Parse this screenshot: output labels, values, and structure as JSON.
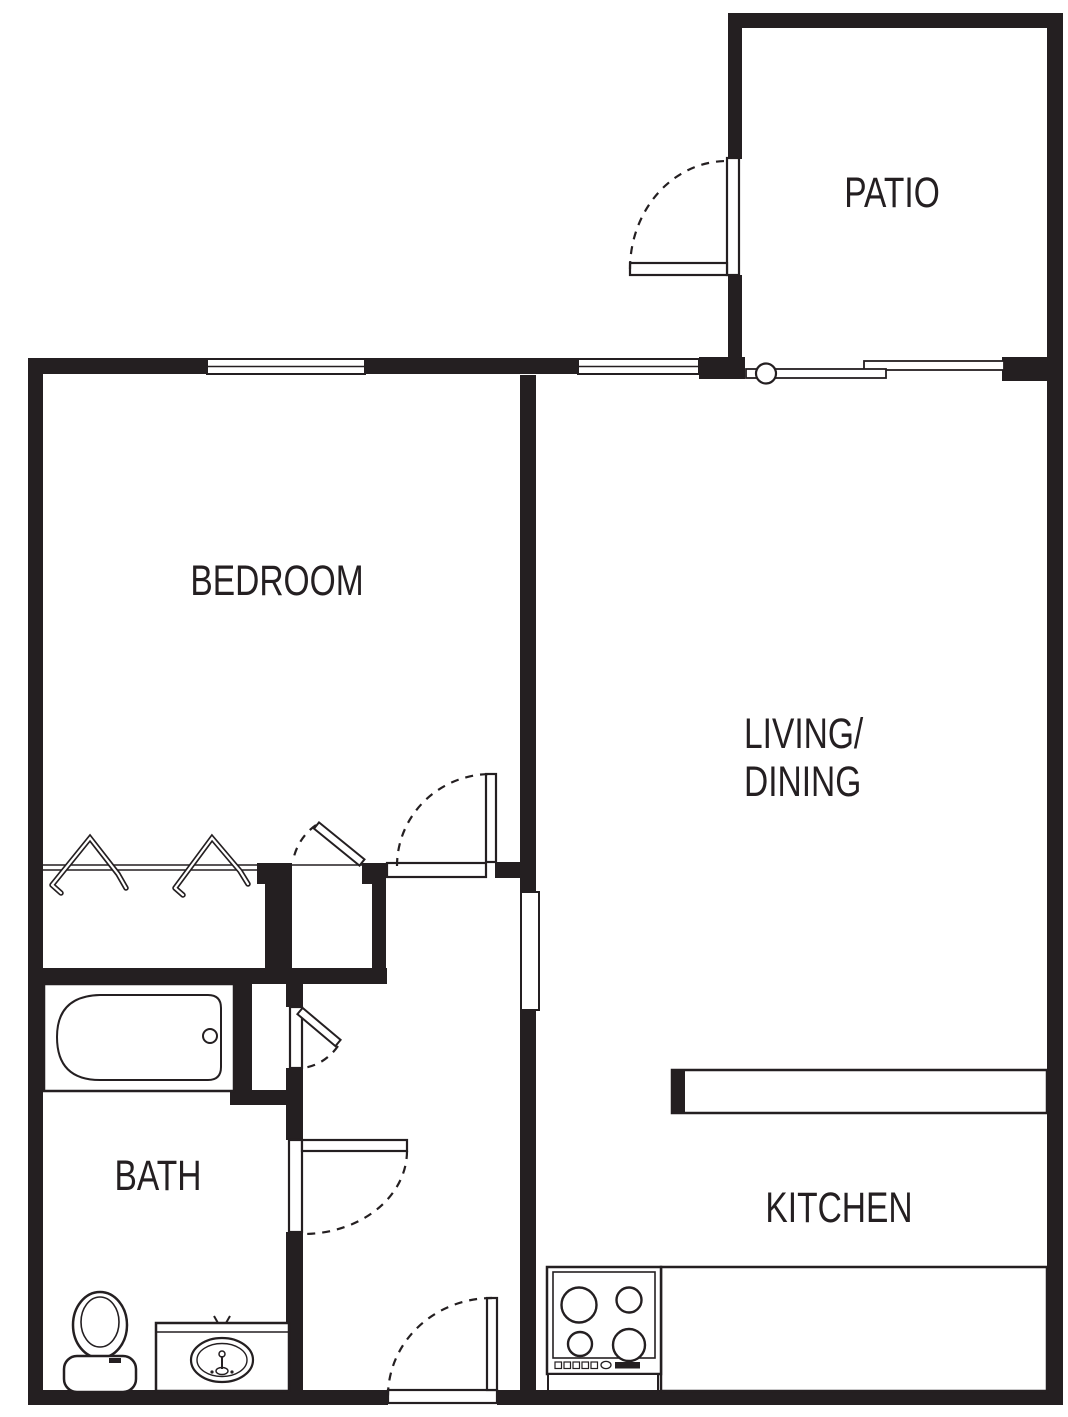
{
  "title": "one-bedroom apartment floor plan",
  "colors": {
    "wall": "#241f21",
    "background": "#ffffff",
    "fixture_line": "#241f21"
  },
  "rooms": {
    "patio": {
      "label": "PATIO"
    },
    "bedroom": {
      "label": "BEDROOM"
    },
    "living_dining": {
      "label_line1": "LIVING/",
      "label_line2": "DINING"
    },
    "bath": {
      "label": "BATH"
    },
    "kitchen": {
      "label": "KITCHEN"
    }
  },
  "fixtures": {
    "bathtub": "bathtub",
    "toilet": "toilet",
    "vanity_sink": "vanity-with-sink",
    "stove": "stove-cooktop",
    "kitchen_counter": "kitchen-counter",
    "breakfast_bar": "breakfast-bar-counter",
    "closet_rod": "closet-rod",
    "clothes_hangers": "clothes-hangers",
    "sliding_glass_door": "sliding-glass-door",
    "windows": "window",
    "swing_doors": "hinged-door"
  }
}
